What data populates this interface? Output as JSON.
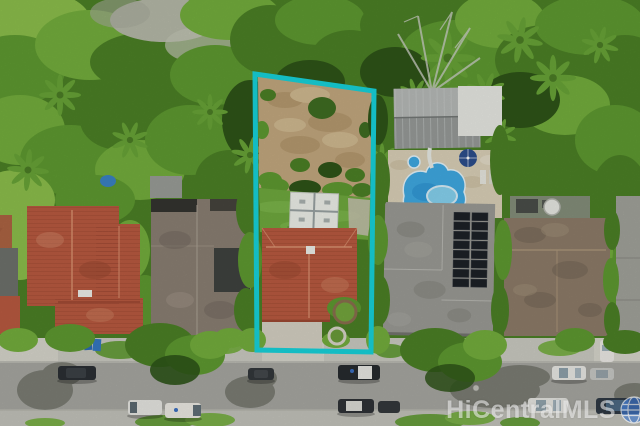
{
  "watermark": {
    "text": "HiCentralMLS"
  },
  "colors": {
    "boundary": "#17d3da",
    "vegetation": "#4c8026",
    "dirt": "#c3a87f",
    "lawn": "#6fa93e",
    "shed": "#eef0e9",
    "pool": "#3fa9e2",
    "pool_light": "#8fd8f2",
    "deck": "#dbd1b8",
    "solar": "#1d2127",
    "road": "#a7a7a1",
    "sidewalk": "#cbcbc2",
    "roof_red": "#b95a40",
    "roof_shingle": "#8a7f73",
    "roof_metal": "#b7bab8",
    "roof_brown": "#8d7c68",
    "roof_gray_edge": "#a2a39b",
    "watermark_blue": "#3b74cb"
  }
}
